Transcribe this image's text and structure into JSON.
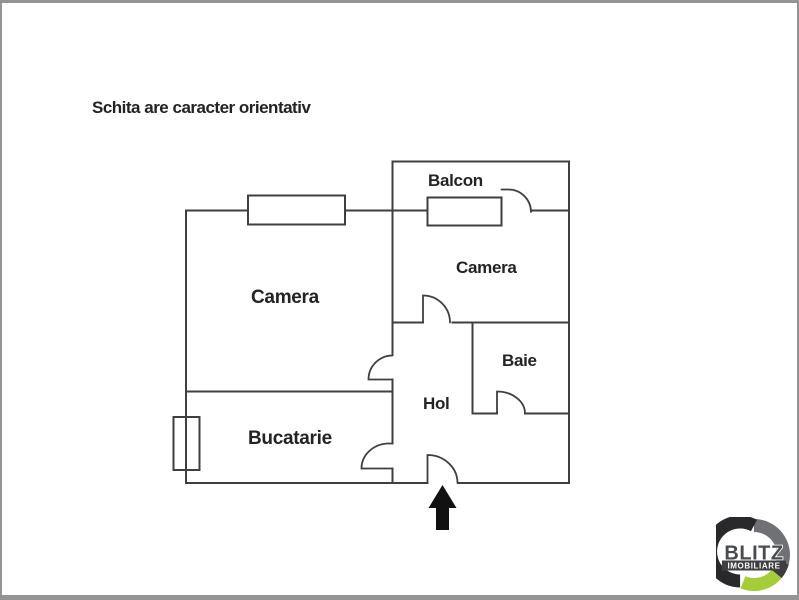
{
  "title": {
    "disclaimer": "Schita are caracter orientativ"
  },
  "floorplan": {
    "rooms": {
      "balcon": "Balcon",
      "camera_right": "Camera",
      "camera_left": "Camera",
      "baie": "Baie",
      "hol": "Hol",
      "bucatarie": "Bucatarie"
    },
    "entrance_arrow_direction": "up",
    "window_count": 3,
    "door_count": 6
  },
  "logo": {
    "brand": "BLITZ",
    "tagline": "IMOBILIARE"
  },
  "colors": {
    "wall": "#3f3f3f",
    "label_text": "#232323",
    "arrow": "#111111",
    "frame": "#949494",
    "logo_light": "#707174",
    "logo_mid": "#3c3c3e",
    "logo_dark": "#29292b",
    "logo_green": "#a5cd39",
    "logo_banner": "#3e3e40",
    "logo_text": "#4a4b4e"
  }
}
